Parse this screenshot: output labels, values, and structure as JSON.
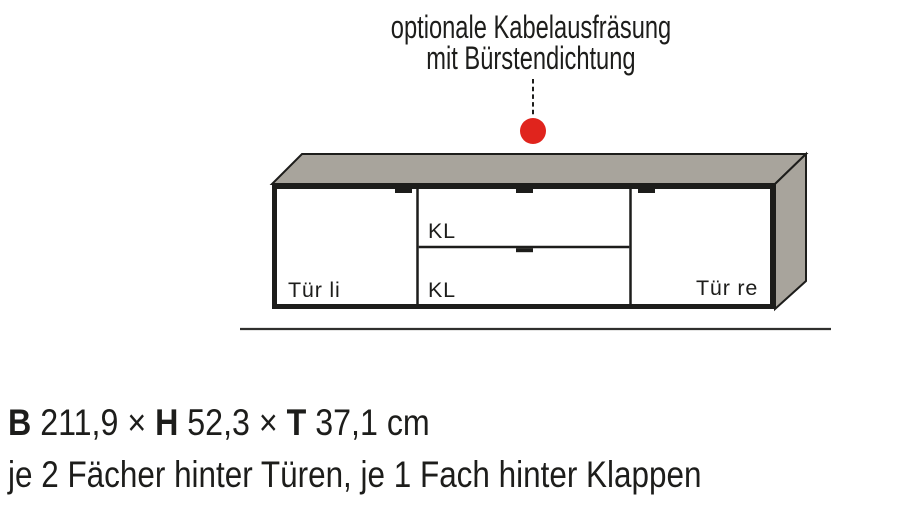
{
  "annotation": {
    "line1": "optionale Kabelausfräsung",
    "line2": "mit Bürstendichtung"
  },
  "cabinet": {
    "door_left_label": "Tür li",
    "flap_top_label": "KL",
    "flap_bottom_label": "KL",
    "door_right_label": "Tür re"
  },
  "specs": {
    "width_label": "B",
    "width_value": "211,9",
    "times1": "×",
    "height_label": "H",
    "height_value": "52,3",
    "times2": "×",
    "depth_label": "T",
    "depth_value": "37,1",
    "unit": "cm",
    "description": "je 2 Fächer hinter Türen, je 1 Fach hinter Klappen"
  },
  "colors": {
    "surface_gray": "#a8a49c",
    "outline": "#1d1d1b",
    "marker_red": "#e0241d",
    "ground_line": "#30302e",
    "text": "#1d1d1b"
  }
}
